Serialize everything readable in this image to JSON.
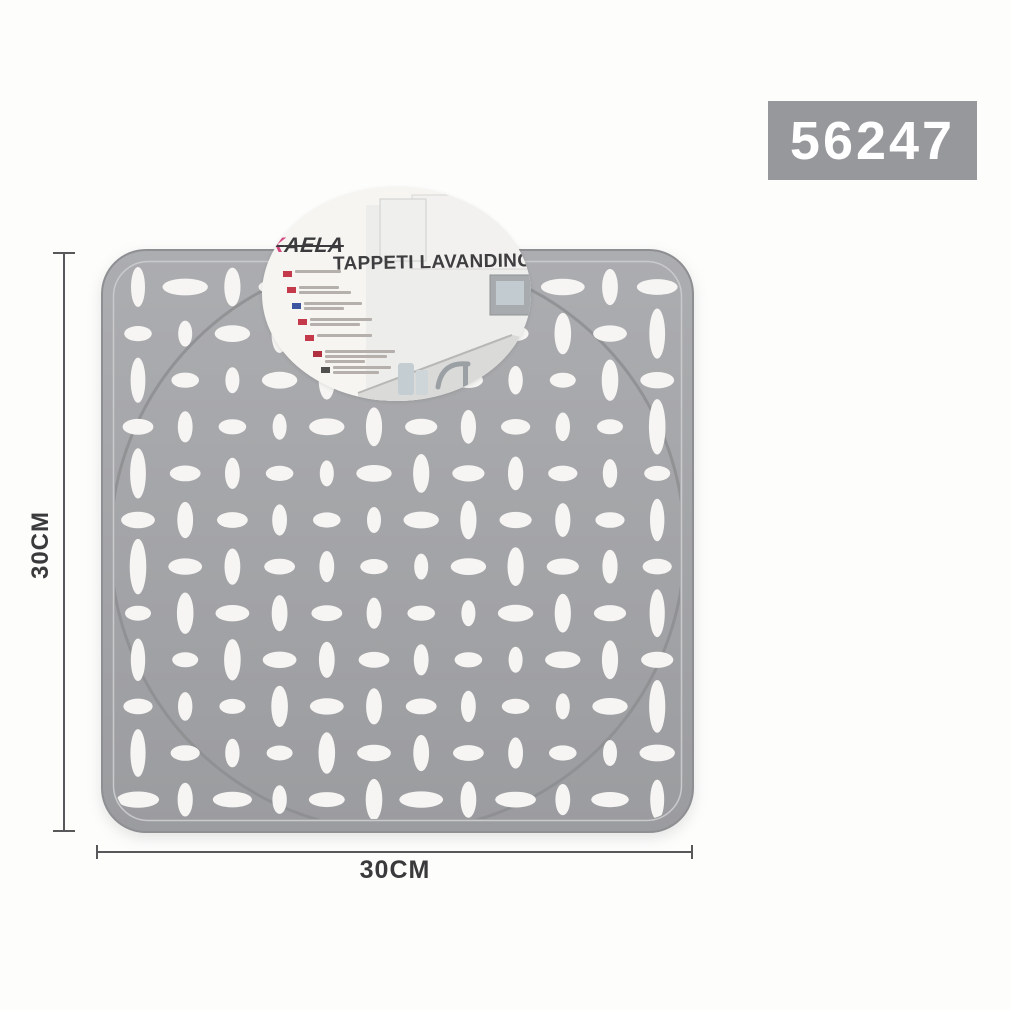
{
  "product": {
    "code": "56247",
    "brand_initial": "K",
    "brand_rest": "AELA",
    "card_title": "TAPPETI LAVANDINO"
  },
  "dimensions": {
    "height_label": "30CM",
    "width_label": "30CM"
  },
  "card": {
    "info_lines": [
      {
        "flag": "#c43a4b",
        "bars": [
          46
        ]
      },
      {
        "flag": "#c43a4b",
        "bars": [
          40,
          52
        ]
      },
      {
        "flag": "#3b55a0",
        "bars": [
          58,
          40
        ]
      },
      {
        "flag": "#c43a4b",
        "bars": [
          62,
          50
        ]
      },
      {
        "flag": "#c43a4b",
        "bars": [
          55
        ]
      },
      {
        "flag": "#b03040",
        "bars": [
          70,
          62,
          40
        ]
      },
      {
        "flag": "#50504f",
        "bars": [
          58,
          46
        ]
      }
    ]
  },
  "colors": {
    "mat_light": "#acadb0",
    "mat_dark": "#9b9c9f",
    "mat_edge": "#8e8f92",
    "mat_groove": "#c9cacc",
    "mat_circle": "#8d8e91",
    "hole": "#f6f5f3",
    "sku_bg": "#97989b",
    "sku_text": "#ffffff",
    "brand_accent": "#d44a80",
    "brand_text": "#3b3b3d",
    "title_text": "#3e3e40",
    "dim": "#58585a"
  }
}
